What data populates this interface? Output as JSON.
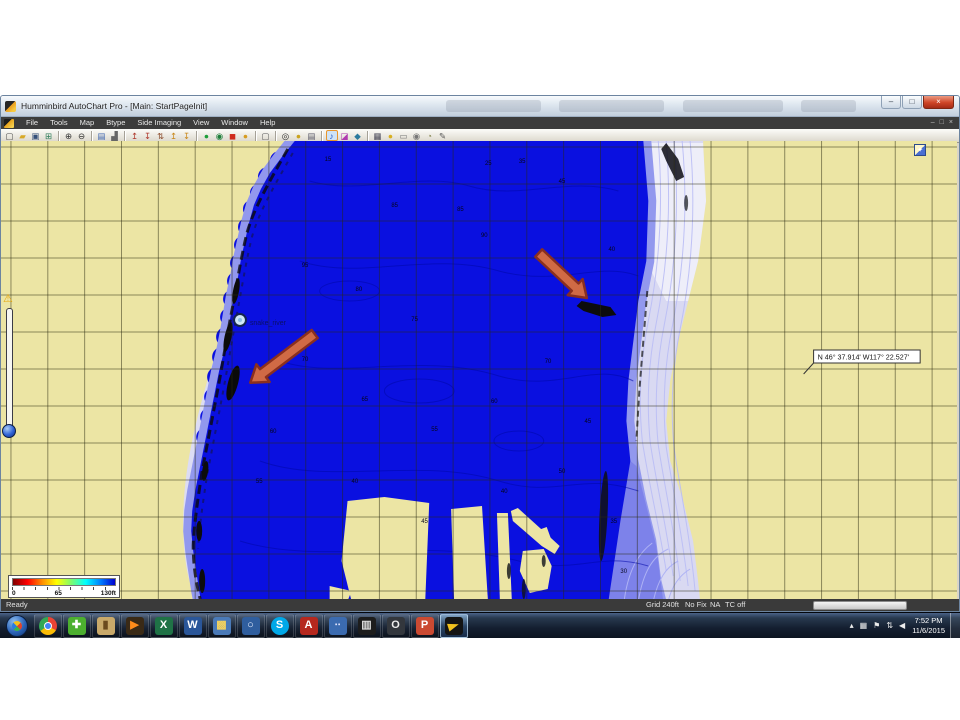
{
  "window": {
    "title": "Humminbird AutoChart Pro - [Main: StartPageInit]",
    "buttons": [
      {
        "name": "minimize-button",
        "glyph": "–"
      },
      {
        "name": "maximize-button",
        "glyph": "□"
      },
      {
        "name": "close-button",
        "glyph": "×",
        "close": true
      }
    ]
  },
  "menu": {
    "items": [
      "File",
      "Tools",
      "Map",
      "Btype",
      "Side Imaging",
      "View",
      "Window",
      "Help"
    ],
    "mdi_controls": [
      {
        "name": "mdi-minimize-icon",
        "glyph": "–"
      },
      {
        "name": "mdi-restore-icon",
        "glyph": "□"
      },
      {
        "name": "mdi-close-icon",
        "glyph": "×"
      }
    ]
  },
  "toolbar": {
    "icons": [
      {
        "name": "new-file-icon",
        "glyph": "▢",
        "fg": "#4a4a4a"
      },
      {
        "name": "open-folder-icon",
        "glyph": "▰",
        "fg": "#d8a927"
      },
      {
        "name": "save-icon",
        "glyph": "▣",
        "fg": "#35507a"
      },
      {
        "name": "save-all-icon",
        "glyph": "⊞",
        "fg": "#2e7d5b"
      },
      {
        "sep": true
      },
      {
        "name": "zoom-in-icon",
        "glyph": "⊕",
        "fg": "#333333"
      },
      {
        "name": "zoom-out-icon",
        "glyph": "⊖",
        "fg": "#333333"
      },
      {
        "sep": true
      },
      {
        "name": "display-icon",
        "glyph": "▤",
        "fg": "#3b63b0"
      },
      {
        "name": "chart-icon",
        "glyph": "▟",
        "fg": "#666666"
      },
      {
        "sep": true
      },
      {
        "name": "import-sonar-icon",
        "glyph": "↥",
        "fg": "#b03a2e"
      },
      {
        "name": "export-sonar-icon",
        "glyph": "↧",
        "fg": "#b03a2e"
      },
      {
        "name": "sync-tracks-icon",
        "glyph": "⇅",
        "fg": "#8a4a2a"
      },
      {
        "name": "import-track-icon",
        "glyph": "↥",
        "fg": "#c9881a"
      },
      {
        "name": "export-track-icon",
        "glyph": "↧",
        "fg": "#c9881a"
      },
      {
        "sep": true
      },
      {
        "name": "start-recording-icon",
        "glyph": "●",
        "fg": "#1d9e3a"
      },
      {
        "name": "live-mode-icon",
        "glyph": "◉",
        "fg": "#1d7e3a"
      },
      {
        "name": "record-icon",
        "glyph": "◼",
        "fg": "#cf2b1d"
      },
      {
        "name": "pause-icon",
        "glyph": "●",
        "fg": "#d79c20"
      },
      {
        "sep": true
      },
      {
        "name": "report-icon",
        "glyph": "▢",
        "fg": "#555555"
      },
      {
        "sep": true
      },
      {
        "name": "target-icon",
        "glyph": "◎",
        "fg": "#333333"
      },
      {
        "name": "gps-icon",
        "glyph": "●",
        "fg": "#caa31f"
      },
      {
        "name": "print-icon",
        "glyph": "▤",
        "fg": "#555566"
      },
      {
        "sep": true
      },
      {
        "name": "depth-notes-icon",
        "glyph": "♪",
        "fg": "#1d56c9",
        "sel": true
      },
      {
        "name": "palette-icon",
        "glyph": "◪",
        "fg": "#b03ab0"
      },
      {
        "name": "measure-icon",
        "glyph": "◆",
        "fg": "#2a7a9e"
      },
      {
        "sep": true
      },
      {
        "name": "grid-icon",
        "glyph": "▦",
        "fg": "#444455"
      },
      {
        "name": "lock-icon",
        "glyph": "●",
        "fg": "#d8b021"
      },
      {
        "name": "mail-icon",
        "glyph": "▭",
        "fg": "#777777"
      },
      {
        "name": "camera-icon",
        "glyph": "◉",
        "fg": "#777777"
      },
      {
        "name": "clock-icon",
        "glyph": "◔",
        "fg": "#888855"
      },
      {
        "name": "edit-icon",
        "glyph": "✎",
        "fg": "#555555"
      }
    ]
  },
  "map": {
    "coordinate_label": "N 46° 37.914' W117° 22.527'",
    "waypoint_label": "snake_river",
    "legend": {
      "start": "0",
      "mid": "65",
      "end": "130ft"
    },
    "depth_labels": [
      {
        "x": 325,
        "y": 20,
        "t": "15"
      },
      {
        "x": 486,
        "y": 24,
        "t": "25"
      },
      {
        "x": 520,
        "y": 22,
        "t": "35"
      },
      {
        "x": 560,
        "y": 42,
        "t": "45"
      },
      {
        "x": 392,
        "y": 66,
        "t": "85"
      },
      {
        "x": 458,
        "y": 70,
        "t": "85"
      },
      {
        "x": 482,
        "y": 96,
        "t": "90"
      },
      {
        "x": 610,
        "y": 110,
        "t": "40"
      },
      {
        "x": 302,
        "y": 126,
        "t": "95"
      },
      {
        "x": 356,
        "y": 150,
        "t": "80"
      },
      {
        "x": 412,
        "y": 180,
        "t": "75"
      },
      {
        "x": 546,
        "y": 222,
        "t": "70"
      },
      {
        "x": 302,
        "y": 220,
        "t": "70"
      },
      {
        "x": 362,
        "y": 260,
        "t": "65"
      },
      {
        "x": 492,
        "y": 262,
        "t": "60"
      },
      {
        "x": 586,
        "y": 282,
        "t": "45"
      },
      {
        "x": 270,
        "y": 292,
        "t": "60"
      },
      {
        "x": 432,
        "y": 290,
        "t": "55"
      },
      {
        "x": 256,
        "y": 342,
        "t": "55"
      },
      {
        "x": 352,
        "y": 342,
        "t": "40"
      },
      {
        "x": 560,
        "y": 332,
        "t": "50"
      },
      {
        "x": 422,
        "y": 382,
        "t": "45"
      },
      {
        "x": 502,
        "y": 352,
        "t": "40"
      },
      {
        "x": 612,
        "y": 382,
        "t": "35"
      },
      {
        "x": 622,
        "y": 432,
        "t": "30"
      }
    ]
  },
  "statusbar": {
    "ready": "Ready",
    "grid": "Grid 240ft",
    "fix": "No Fix",
    "sat": "NA",
    "tc": "TC off"
  },
  "taskbar": {
    "apps": [
      {
        "name": "taskbar-chrome-icon",
        "kind": "chrome"
      },
      {
        "name": "taskbar-green-app-icon",
        "glyph": "✚",
        "fg": "#ffffff",
        "bg": "#4caf2f"
      },
      {
        "name": "taskbar-statue-app-icon",
        "glyph": "▮",
        "fg": "#6b4a1e",
        "bg": "#c9a96a"
      },
      {
        "name": "taskbar-media-app-icon",
        "glyph": "▶",
        "fg": "#ff8c1a",
        "bg": "#3a2a16"
      },
      {
        "name": "taskbar-excel-icon",
        "glyph": "X",
        "fg": "#ffffff",
        "bg": "#1f7246"
      },
      {
        "name": "taskbar-word-icon",
        "glyph": "W",
        "fg": "#ffffff",
        "bg": "#2a5699"
      },
      {
        "name": "taskbar-photos-icon",
        "glyph": "▩",
        "fg": "#f4d35e",
        "bg": "#4a7ab8"
      },
      {
        "name": "taskbar-search-map-icon",
        "glyph": "○",
        "fg": "#e8f0ff",
        "bg": "#2f5e9e"
      },
      {
        "name": "taskbar-skype-icon",
        "glyph": "S",
        "fg": "#ffffff",
        "bg": "#00a8e8",
        "round": true
      },
      {
        "name": "taskbar-adobe-reader-icon",
        "glyph": "A",
        "fg": "#ffffff",
        "bg": "#b5281e"
      },
      {
        "name": "taskbar-people-app-icon",
        "glyph": "∙∙",
        "fg": "#e8e8ff",
        "bg": "#3b6bb0"
      },
      {
        "name": "taskbar-movie-app-icon",
        "glyph": "▥",
        "fg": "#dddddd",
        "bg": "#1d1d1d"
      },
      {
        "name": "taskbar-ring-app-icon",
        "glyph": "O",
        "fg": "#eeeeee",
        "bg": "#33373d"
      },
      {
        "name": "taskbar-powerpoint-icon",
        "glyph": "P",
        "fg": "#ffffff",
        "bg": "#cb4a32"
      },
      {
        "name": "taskbar-autochart-icon",
        "kind": "bird",
        "active": true
      }
    ],
    "tray": [
      {
        "name": "tray-hidden-icons",
        "glyph": "▴"
      },
      {
        "name": "tray-action-center-icon",
        "glyph": "▦"
      },
      {
        "name": "tray-flag-icon",
        "glyph": "⚑"
      },
      {
        "name": "tray-network-icon",
        "glyph": "⇅"
      },
      {
        "name": "tray-volume-icon",
        "glyph": "◀"
      }
    ],
    "clock": {
      "time": "7:52 PM",
      "date": "11/6/2015"
    }
  },
  "colors": {
    "lake": "#0a10e0",
    "shallow_band": "#9298ee",
    "shore": "#dcdcf4",
    "land": "#ece5a4",
    "grid_line": "#2a2a10",
    "arrow_fill": "#d06a45",
    "arrow_stroke": "#8a2f1e",
    "legend_gradient": [
      "#800000",
      "#ff0000",
      "#ff8c00",
      "#ffff00",
      "#7cfc6e",
      "#00ffff",
      "#0080ff",
      "#0000d0"
    ]
  }
}
